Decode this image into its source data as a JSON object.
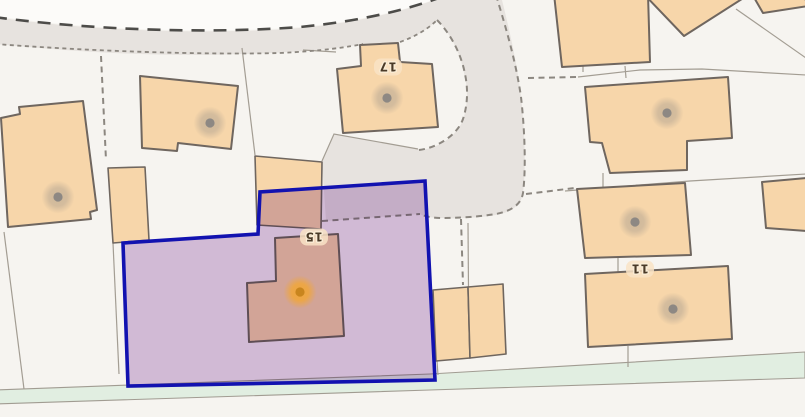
{
  "map": {
    "view": "cadastral-parcel-map",
    "selected_parcel_label": "15",
    "labels": [
      {
        "id": "house-17",
        "text": "17",
        "x": 388,
        "y": 67,
        "rotated": true,
        "halo": true
      },
      {
        "id": "house-15",
        "text": "15",
        "x": 314,
        "y": 237,
        "rotated": true,
        "halo": true
      },
      {
        "id": "house-11",
        "text": "11",
        "x": 640,
        "y": 269,
        "rotated": true,
        "halo": true
      }
    ],
    "markers": [
      {
        "type": "selected",
        "x": 300,
        "y": 292,
        "building": "15"
      },
      {
        "type": "default",
        "x": 58,
        "y": 197
      },
      {
        "type": "default",
        "x": 210,
        "y": 123
      },
      {
        "type": "default",
        "x": 387,
        "y": 98,
        "building": "17"
      },
      {
        "type": "default",
        "x": 667,
        "y": 113
      },
      {
        "type": "default",
        "x": 635,
        "y": 222
      },
      {
        "type": "default",
        "x": 673,
        "y": 309,
        "building": "11"
      }
    ],
    "colors": {
      "background": "#f6f4f0",
      "above_road": "#fcfbf9",
      "road": "#e7e3df",
      "building_fill": "#f7d6aa",
      "building_stroke": "#6f665f",
      "selected_parcel_fill": "#d9c3e3",
      "selected_parcel_stroke": "#1212b0",
      "green_strip": "#e1eee1",
      "parcel_line": "#a39d93",
      "dashed_line": "#8c8780",
      "road_casing_dash": "#4d4c49",
      "marker_dot": "#8d8883",
      "marker_halo": "#8d8883",
      "marker_selected_dot": "#c8851e",
      "marker_selected_halo": "#f0a63a",
      "label_text": "#4a3a28",
      "label_halo": "#f9e3c5"
    }
  }
}
